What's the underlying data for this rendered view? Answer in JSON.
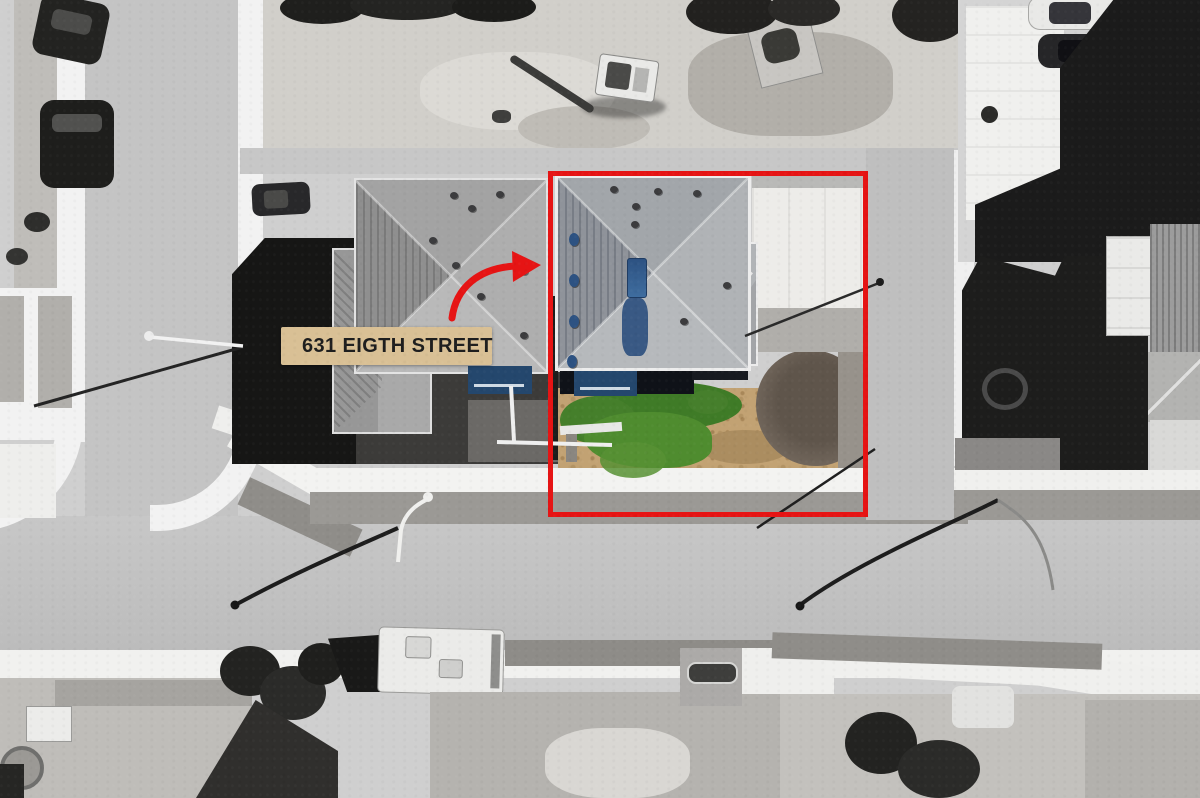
{
  "annotation": {
    "address_label": {
      "text": "631 EIGTH STREET",
      "icon": "map-pin"
    },
    "property_boundary": {
      "type": "rectangle-outline"
    },
    "pointer_arrow": {
      "type": "curved-arrow"
    }
  },
  "colors": {
    "accent-red": "#e61414",
    "label-bg": "#d9c095",
    "label-text": "#1e1e1e",
    "pin-red": "#d6261a",
    "grass-green": "#3f7b27",
    "grass-light": "#579134",
    "dirt-tan": "#c2a273",
    "mound-brown": "#6b5f55",
    "roof-blue": "#2d5282",
    "wall-blue": "#24476d"
  }
}
